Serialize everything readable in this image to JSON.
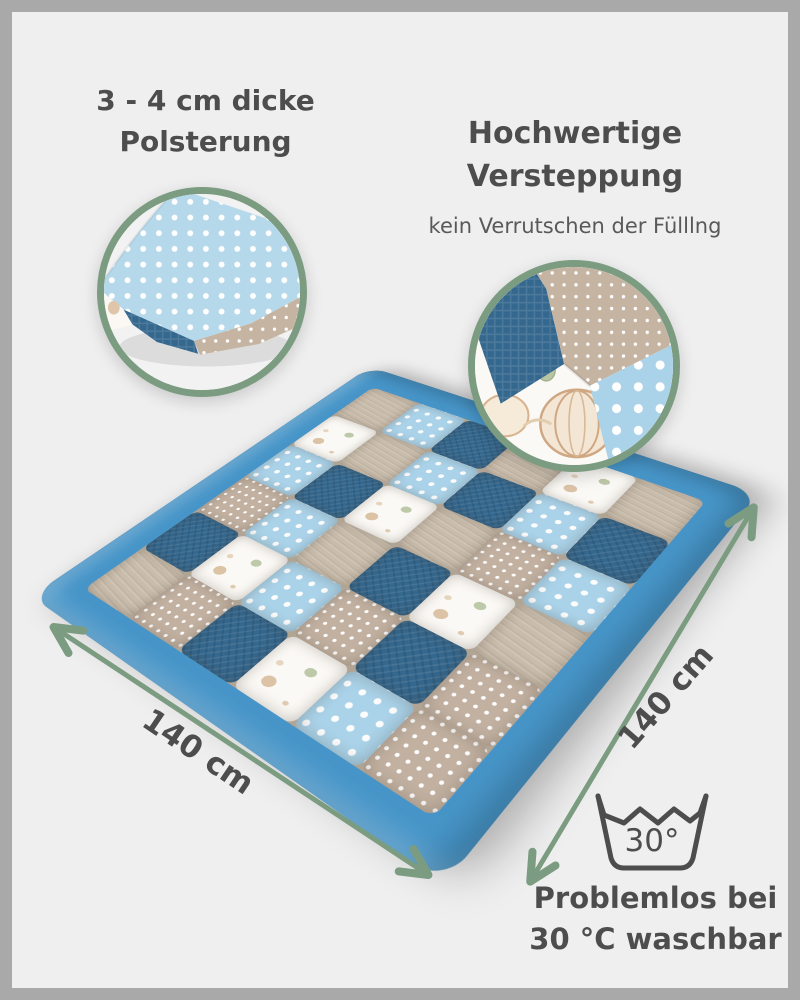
{
  "colors": {
    "background": "#efefef",
    "frame": "#a9a9a9",
    "text": "#4d4d4d",
    "subtext": "#595959",
    "accent_green": "#7b9c80",
    "quilt_border_blue": "#4795c8",
    "fabric_light_blue": "#aad2e8",
    "fabric_dark_blue": "#35688e",
    "fabric_beige": "#c9bcab",
    "fabric_beige_dot": "#c2b1a1",
    "fabric_white": "#fbf9f5"
  },
  "annotations": {
    "padding": {
      "line1": "3 - 4 cm dicke",
      "line2": "Polsterung"
    },
    "quilting": {
      "line1": "Hochwertige",
      "line2": "Versteppung",
      "subtitle": "kein Verrutschen der Fülllng"
    },
    "washing": {
      "temp_label": "30°",
      "line1": "Problemlos bei",
      "line2": "30 °C waschbar"
    },
    "dimensions": {
      "left": "140 cm",
      "right": "140 cm"
    }
  },
  "quilt": {
    "grid_size": 6,
    "fabric_legend": {
      "lb": "light-blue-polka-dot",
      "db": "dark-blue-waffle",
      "be": "beige-corduroy",
      "bp": "beige-polka-dot",
      "wb": "white-hot-air-balloon-print"
    },
    "grid": [
      [
        "be",
        "db",
        "bp",
        "lb",
        "wb",
        "be"
      ],
      [
        "bp",
        "wb",
        "lb",
        "db",
        "be",
        "lb"
      ],
      [
        "db",
        "lb",
        "be",
        "wb",
        "lb",
        "db"
      ],
      [
        "wb",
        "bp",
        "db",
        "be",
        "db",
        "be"
      ],
      [
        "lb",
        "db",
        "wb",
        "bp",
        "lb",
        "wb"
      ],
      [
        "bp",
        "bp",
        "be",
        "lb",
        "db",
        "be"
      ]
    ]
  }
}
